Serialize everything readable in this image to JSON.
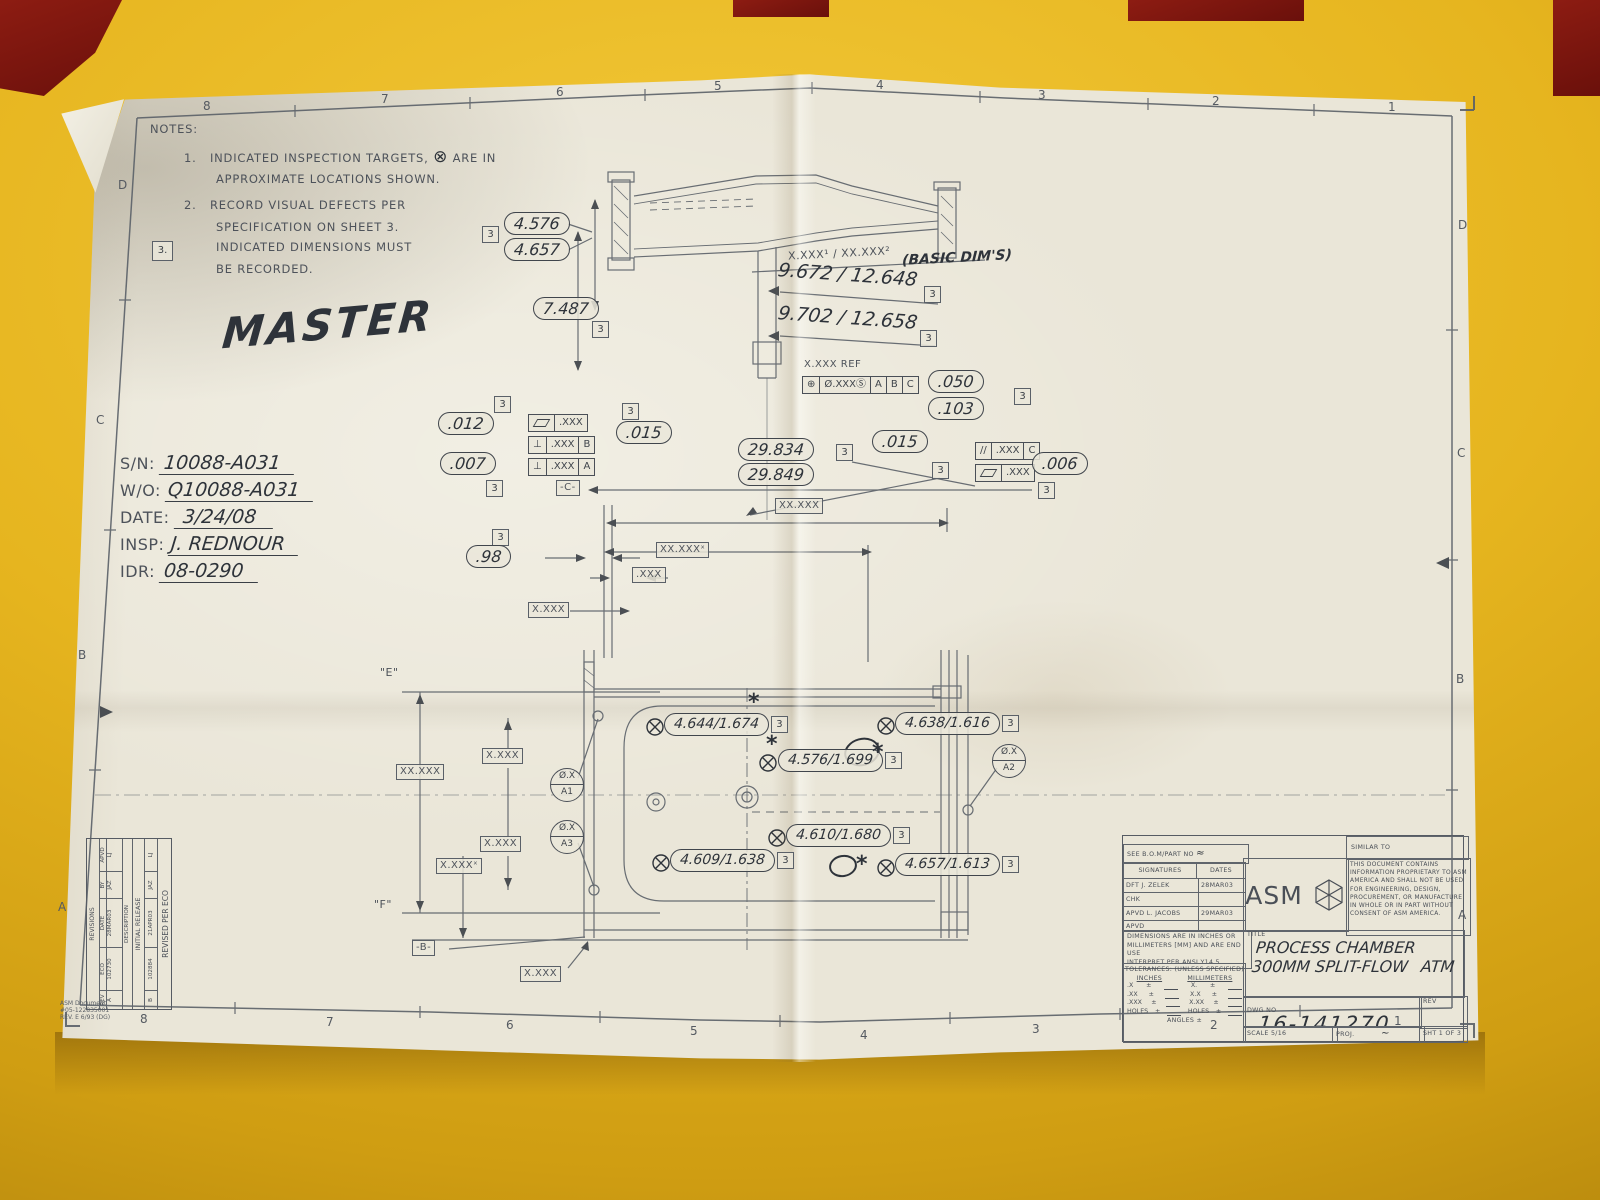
{
  "colors": {
    "table": "#e3b11d",
    "paper": "#eae6d8",
    "line": "#5a6068",
    "ink": "#2e333a",
    "red": "#7f150f",
    "boxbg": "rgba(234,230,217,0.85)"
  },
  "zones": {
    "top": [
      "8",
      "7",
      "6",
      "5",
      "4",
      "3",
      "2",
      "1"
    ],
    "bottom": [
      "8",
      "7",
      "6",
      "5",
      "4",
      "3",
      "2",
      "1"
    ],
    "left": [
      "D",
      "C",
      "B",
      "A"
    ],
    "right": [
      "D",
      "C",
      "B",
      "A"
    ]
  },
  "notes": {
    "heading": "NOTES:",
    "n1a": "1.",
    "n1b": "INDICATED INSPECTION TARGETS,",
    "n1c": "ARE IN",
    "n1d": "APPROXIMATE LOCATIONS SHOWN.",
    "n2a": "2.",
    "n2b": "RECORD VISUAL DEFECTS PER",
    "n2c": "SPECIFICATION ON SHEET 3.",
    "n3a": "3.",
    "n3b": "INDICATED DIMENSIONS MUST",
    "n3c": "BE RECORDED."
  },
  "stamp": "MASTER",
  "record": {
    "sn_l": "S/N:",
    "sn": "10088-A031",
    "wo_l": "W/O:",
    "wo": "Q10088-A031",
    "date_l": "DATE:",
    "date": "3/24/08",
    "insp_l": "INSP:",
    "insp": "J. REDNOUR",
    "idr_l": "IDR:",
    "idr": "08-0290"
  },
  "flag": "3",
  "dims": {
    "d4576": "4.576",
    "d4657": "4.657",
    "d7487": "7.487",
    "basic": "X.XXX¹ / XX.XXX²",
    "basic_note": "(BASIC DIM'S)",
    "hw_a": "9.672 / 12.648",
    "hw_b": "9.702 / 12.658",
    "xxx_ref": "X.XXX REF",
    "d050": ".050",
    "d103": ".103",
    "d012": ".012",
    "d007": ".007",
    "d015a": ".015",
    "d29834": "29.834",
    "d29849": "29.849",
    "d015b": ".015",
    "d006": ".006",
    "d98": ".98",
    "xxxx": "XX.XXX",
    "xxxx2": "XX.XXXˣ",
    "xxx": ".XXX",
    "x_xxx": "X.XXX",
    "x_xxx2": "X.XXXˣ",
    "t1": "4.644/1.674",
    "t2": "4.576/1.699",
    "t3": "4.638/1.616",
    "t4": "4.610/1.680",
    "t5": "4.609/1.638",
    "t6": "4.657/1.613",
    "e": "\"E\"",
    "f": "\"F\""
  },
  "fcf": {
    "pos_sym": "⊕",
    "pos_tol": "Ø.XXX",
    "pos_mod": "Ⓢ",
    "dA": "A",
    "dB": "B",
    "dC": "C",
    "perp_sym": "⊥",
    "par_sym": "//",
    "tol": ".XXX",
    "datum_b": "-B-",
    "datum_c": "-C-"
  },
  "targets": {
    "a1t": "Ø.X",
    "a1b": "A1",
    "a2t": "Ø.X",
    "a2b": "A2",
    "a3t": "Ø.X",
    "a3b": "A3"
  },
  "titleblock": {
    "see_bom": "SEE B.O.M/PART NO",
    "see_bom_mark": "≈",
    "similar": "SIMILAR TO",
    "sig_h": "SIGNATURES",
    "dates_h": "DATES",
    "r1l": "DFT  J. ZELEK",
    "r1d": "28MAR03",
    "r2l": "CHK",
    "r2d": "",
    "r3l": "APVD L. JACOBS",
    "r3d": "29MAR03",
    "r4l": "APVD",
    "r4d": "",
    "brand": "ASM",
    "prop": "THIS DOCUMENT CONTAINS INFORMATION PROPRIETARY TO ASM AMERICA AND SHALL NOT BE USED FOR ENGINEERING, DESIGN, PROCUREMENT, OR MANUFACTURE IN WHOLE OR IN PART WITHOUT CONSENT OF ASM AMERICA.",
    "dims_note1": "DIMENSIONS ARE IN INCHES OR",
    "dims_note2": "MILLIMETERS [MM] AND ARE END USE",
    "dims_note3": "INTERPRET PER ANSI Y14.5",
    "tol_h": "TOLERANCES: (UNLESS SPECIFIED)",
    "in_h": "INCHES",
    "mm_h": "MILLIMETERS",
    "tin": [
      ".X",
      ".XX",
      ".XXX",
      "HOLES"
    ],
    "tmm": [
      "X.",
      "X.X",
      "X.XX",
      "HOLES"
    ],
    "angles": "ANGLES ±",
    "title_l": "TITLE",
    "t1": "PROCESS CHAMBER",
    "t2": "300MM SPLIT-FLOW",
    "t3": "ATM",
    "dwg_l": "DWG NO",
    "dwg": "16-141270",
    "rev_l": "REV",
    "scale": "SCALE 5/16",
    "proj": "PROJ.",
    "proj_mark": "~",
    "sht": "SHT 1 OF 3"
  },
  "revblock": {
    "h": "REVISIONS",
    "c_rev": "REV",
    "c_eco": "ECO",
    "c_date": "DATE",
    "c_by": "BY",
    "c_apvd": "APVD",
    "c_desc": "DESCRIPTION",
    "a_rev": "A",
    "a_eco": "102730",
    "a_date": "28MAR03",
    "a_by": "JAZ",
    "a_apvd": "LJ",
    "a_desc": "INITIAL RELEASE",
    "b_rev": "B",
    "b_eco": "102884",
    "b_date": "21APR03",
    "b_by": "JAZ",
    "b_apvd": "LJ",
    "b_desc": "REVISED PER ECO",
    "doc1": "ASM Document",
    "doc2": "#05-122835001",
    "doc3": "REV. E 6/93 (DG)"
  }
}
